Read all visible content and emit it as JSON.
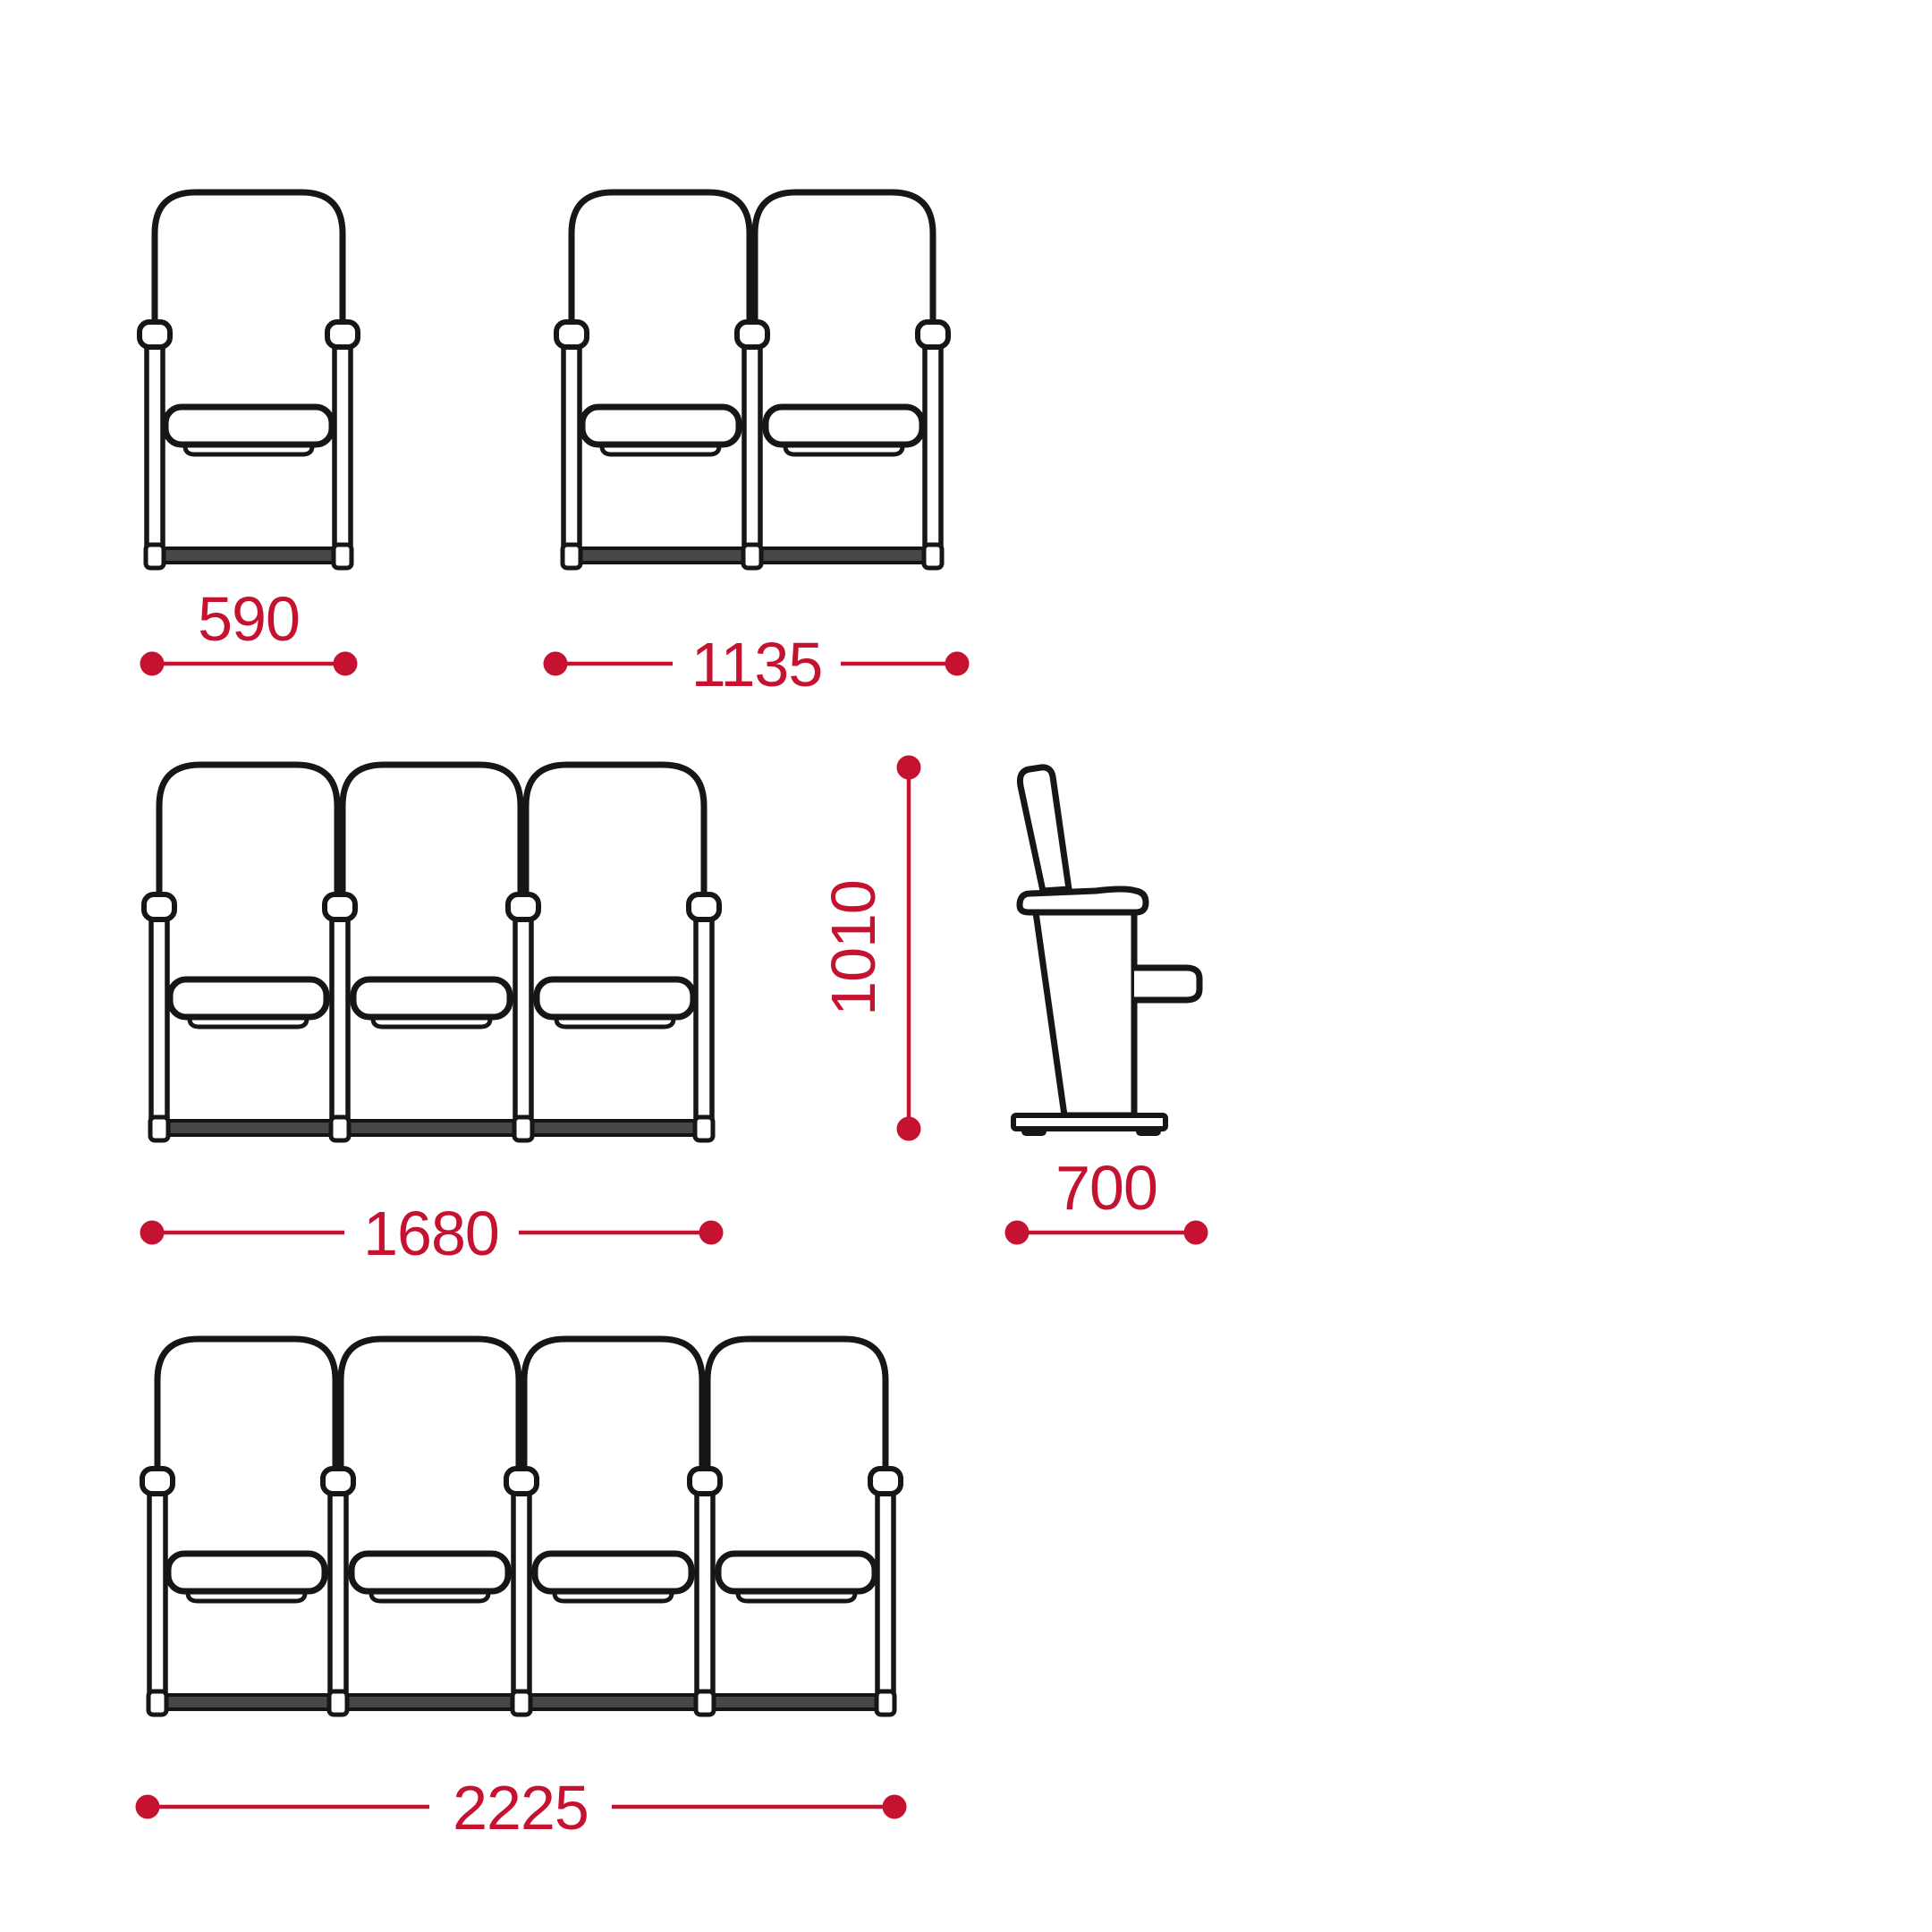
{
  "diagram": {
    "subject": "Folding auditorium chair — dimensional line drawing",
    "drawing_style": "black outline front/side views with red dimension lines",
    "colors": {
      "dimension_red": "#c41230",
      "outline_black": "#161616",
      "background": "#ffffff"
    },
    "labels": {
      "w1": "590",
      "w2": "1135",
      "w3": "1680",
      "w4": "2225",
      "height": "1010",
      "depth": "700"
    },
    "views": [
      {
        "id": "front-1-seat",
        "type": "front view",
        "seats": 1,
        "width_mm": 590
      },
      {
        "id": "front-2-seat",
        "type": "front view",
        "seats": 2,
        "width_mm": 1135
      },
      {
        "id": "front-3-seat",
        "type": "front view",
        "seats": 3,
        "width_mm": 1680
      },
      {
        "id": "side-view",
        "type": "side view",
        "height_mm": 1010,
        "depth_mm": 700
      },
      {
        "id": "front-4-seat",
        "type": "front view",
        "seats": 4,
        "width_mm": 2225
      }
    ]
  }
}
